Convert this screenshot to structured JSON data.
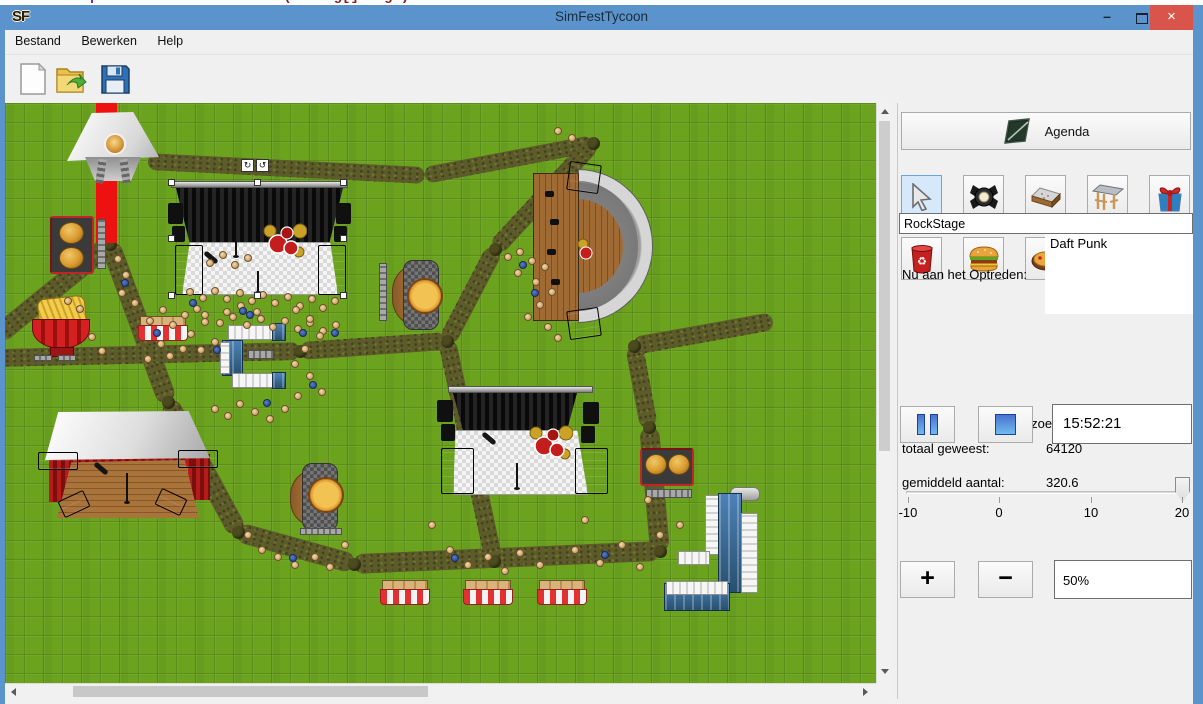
{
  "background_window": {
    "line_number": "180",
    "code_keywords": "public static void ",
    "code_rest": "main(String[] args)"
  },
  "window": {
    "title": "SimFestTycoon",
    "icon": "SF",
    "minimize_glyph": "–",
    "close_glyph": "×"
  },
  "menu": {
    "items": [
      {
        "label": "Bestand"
      },
      {
        "label": "Bewerken"
      },
      {
        "label": "Help"
      }
    ]
  },
  "toolbar": {
    "buttons": [
      "new-file",
      "open-file",
      "save-file"
    ]
  },
  "panel": {
    "agenda_label": "Agenda",
    "tools_row1": [
      "select-cursor",
      "spotlight",
      "stage-floor",
      "stage-roof",
      "gift"
    ],
    "tools_row2": [
      "trash-can",
      "burger",
      "pizza",
      "fries",
      "toilet-paper"
    ],
    "selected_tool": "select-cursor",
    "stage_name": "RockStage",
    "now_performing_label": "Nu aan het Optreden:",
    "now_performing": "Daft Punk",
    "visitors_header": "Bezoekers",
    "total_label": "totaal geweest:",
    "total_value": "64120",
    "avg_label": "gemiddeld aantal:",
    "avg_value": "320.6",
    "time": "15:52:21",
    "slider": {
      "ticks": [
        "-10",
        "0",
        "10",
        "20"
      ],
      "value": 20
    },
    "zoom_in": "+",
    "zoom_out": "−",
    "zoom_level": "50%"
  },
  "colors": {
    "titlebar": "#5b94cd",
    "close_button": "#d9544b",
    "grass": "#6ba31f",
    "dirt_path": "#5e5b2a",
    "selected_tool_bg": "#d6e9fb",
    "control_blue": "#4a72cf",
    "red_carpet": "#ee1111"
  },
  "map": {
    "structures": [
      "party-tent",
      "rock-stage",
      "amphitheater",
      "south-stage",
      "tent-stage",
      "burger-stand-north",
      "burger-stand-east",
      "fries-stand",
      "pizza-stand-north",
      "pizza-stand-south",
      "market-stall-west",
      "market-stall-1",
      "market-stall-2",
      "market-stall-3",
      "toilet-block-c",
      "toilet-block-east"
    ],
    "red_carpet_rect": [
      91,
      0,
      21,
      140
    ],
    "paths": [
      [
        -8,
        233,
        105,
        141,
        20
      ],
      [
        102,
        0,
        102,
        145,
        20
      ],
      [
        105,
        141,
        163,
        299,
        20
      ],
      [
        143,
        58,
        420,
        72,
        17
      ],
      [
        420,
        72,
        588,
        40,
        17
      ],
      [
        588,
        40,
        490,
        146,
        18
      ],
      [
        490,
        146,
        442,
        238,
        18
      ],
      [
        442,
        238,
        295,
        248,
        18
      ],
      [
        -8,
        255,
        295,
        248,
        18
      ],
      [
        163,
        299,
        233,
        429,
        20
      ],
      [
        233,
        429,
        349,
        461,
        20
      ],
      [
        349,
        461,
        655,
        448,
        20
      ],
      [
        655,
        448,
        644,
        324,
        20
      ],
      [
        644,
        324,
        629,
        243,
        18
      ],
      [
        629,
        243,
        768,
        218,
        18
      ],
      [
        442,
        238,
        489,
        458,
        18
      ]
    ],
    "knots": [
      [
        105,
        141
      ],
      [
        163,
        299
      ],
      [
        233,
        429
      ],
      [
        349,
        461
      ],
      [
        442,
        238
      ],
      [
        295,
        248
      ],
      [
        490,
        146
      ],
      [
        655,
        448
      ],
      [
        644,
        324
      ],
      [
        588,
        40
      ],
      [
        489,
        458
      ],
      [
        629,
        243
      ]
    ],
    "crowd": {
      "tan": [
        [
          185,
          189
        ],
        [
          198,
          195
        ],
        [
          210,
          188
        ],
        [
          222,
          196
        ],
        [
          235,
          190
        ],
        [
          247,
          198
        ],
        [
          258,
          192
        ],
        [
          270,
          200
        ],
        [
          283,
          194
        ],
        [
          295,
          203
        ],
        [
          307,
          196
        ],
        [
          318,
          205
        ],
        [
          330,
          198
        ],
        [
          200,
          212
        ],
        [
          215,
          220
        ],
        [
          228,
          214
        ],
        [
          242,
          222
        ],
        [
          256,
          216
        ],
        [
          268,
          224
        ],
        [
          280,
          218
        ],
        [
          293,
          226
        ],
        [
          305,
          220
        ],
        [
          318,
          228
        ],
        [
          331,
          222
        ],
        [
          205,
          160
        ],
        [
          218,
          152
        ],
        [
          230,
          162
        ],
        [
          243,
          155
        ],
        [
          145,
          218
        ],
        [
          158,
          207
        ],
        [
          168,
          222
        ],
        [
          180,
          212
        ],
        [
          192,
          206
        ],
        [
          200,
          219
        ],
        [
          186,
          231
        ],
        [
          156,
          241
        ],
        [
          143,
          256
        ],
        [
          165,
          253
        ],
        [
          178,
          246
        ],
        [
          196,
          247
        ],
        [
          210,
          239
        ],
        [
          222,
          209
        ],
        [
          236,
          203
        ],
        [
          252,
          209
        ],
        [
          291,
          207
        ],
        [
          305,
          216
        ],
        [
          315,
          233
        ],
        [
          300,
          246
        ],
        [
          290,
          261
        ],
        [
          305,
          273
        ],
        [
          317,
          289
        ],
        [
          293,
          293
        ],
        [
          280,
          306
        ],
        [
          265,
          316
        ],
        [
          250,
          309
        ],
        [
          235,
          301
        ],
        [
          223,
          313
        ],
        [
          210,
          306
        ],
        [
          503,
          154
        ],
        [
          515,
          149
        ],
        [
          527,
          158
        ],
        [
          540,
          164
        ],
        [
          513,
          170
        ],
        [
          531,
          179
        ],
        [
          547,
          189
        ],
        [
          535,
          202
        ],
        [
          523,
          214
        ],
        [
          543,
          224
        ],
        [
          553,
          235
        ],
        [
          553,
          28
        ],
        [
          567,
          35
        ],
        [
          427,
          422
        ],
        [
          445,
          447
        ],
        [
          463,
          462
        ],
        [
          483,
          454
        ],
        [
          500,
          468
        ],
        [
          515,
          450
        ],
        [
          535,
          462
        ],
        [
          570,
          447
        ],
        [
          595,
          460
        ],
        [
          617,
          442
        ],
        [
          635,
          464
        ],
        [
          655,
          432
        ],
        [
          675,
          422
        ],
        [
          643,
          397
        ],
        [
          580,
          417
        ],
        [
          243,
          432
        ],
        [
          257,
          447
        ],
        [
          273,
          454
        ],
        [
          290,
          462
        ],
        [
          310,
          454
        ],
        [
          325,
          464
        ],
        [
          340,
          442
        ],
        [
          63,
          198
        ],
        [
          75,
          206
        ],
        [
          113,
          156
        ],
        [
          121,
          172
        ],
        [
          117,
          190
        ],
        [
          130,
          200
        ],
        [
          87,
          234
        ],
        [
          97,
          248
        ]
      ],
      "blue": [
        [
          188,
          200
        ],
        [
          245,
          212
        ],
        [
          298,
          230
        ],
        [
          152,
          230
        ],
        [
          212,
          247
        ],
        [
          262,
          300
        ],
        [
          308,
          282
        ],
        [
          518,
          162
        ],
        [
          530,
          190
        ],
        [
          450,
          455
        ],
        [
          600,
          452
        ],
        [
          288,
          455
        ],
        [
          120,
          180
        ],
        [
          238,
          208
        ],
        [
          330,
          230
        ]
      ]
    },
    "selection": {
      "handles": [
        [
          166,
          79
        ],
        [
          252,
          79
        ],
        [
          338,
          79
        ],
        [
          166,
          135
        ],
        [
          338,
          135
        ],
        [
          166,
          192
        ],
        [
          252,
          192
        ],
        [
          338,
          192
        ]
      ],
      "rotate_glyphs": [
        "↻",
        "↺"
      ]
    }
  }
}
